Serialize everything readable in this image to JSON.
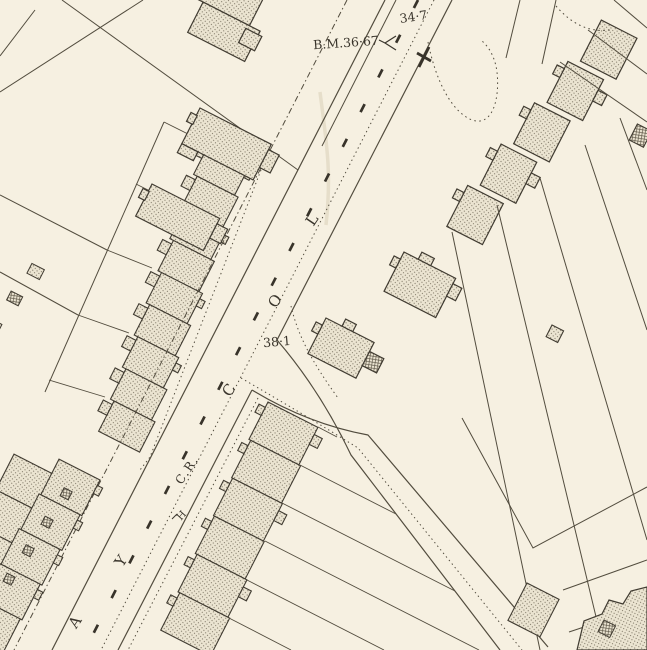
{
  "map": {
    "description": "Historic Ordnance Survey style town plan extract",
    "paper_color": "#f6f0e1",
    "ink_color": "#46413a",
    "labels": {
      "spot_height_top": "34·7",
      "benchmark": "B.M.36·67",
      "spot_height_junction": "38·1",
      "boundary_abbrev": "C.R.",
      "hydrant_mark": "H"
    },
    "street_letters": [
      "L",
      "O",
      "C",
      "Y",
      "A"
    ]
  }
}
